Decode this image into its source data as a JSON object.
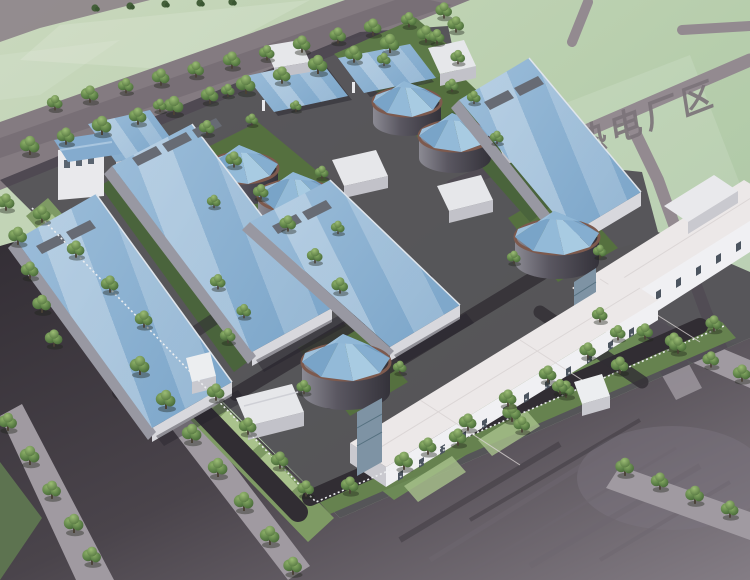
{
  "scene": {
    "type": "architectural-aerial-rendering",
    "area_label": "热电厂区",
    "counts": {
      "blue_roof_halls": 6,
      "round_tanks": 6,
      "canopies": 2,
      "white_long_buildings": 2
    },
    "palette": {
      "roof_blue": "#8fb4d4",
      "roof_ridge_light": "#a9c6df",
      "field_green": "#c3d5b4",
      "site_lawn": "#55703f",
      "asphalt_dark": "#3a343b",
      "parking_gray": "#5d565c",
      "outer_road": "#8a8085",
      "sidewalk": "#9d979d",
      "building_white": "#e9e9ec",
      "tree_green": "#5c8047",
      "tank_ring_brown": "#7d5a4e",
      "label_gray": "#7c747a"
    }
  }
}
